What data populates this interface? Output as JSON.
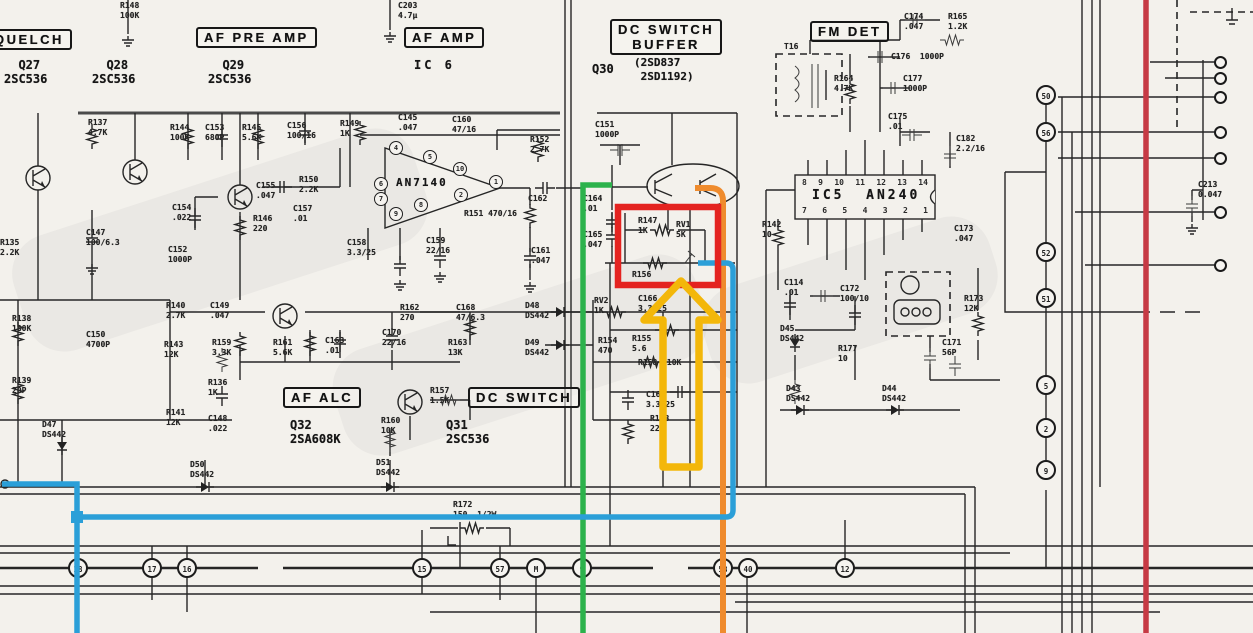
{
  "sections": {
    "squelch": "QUELCH",
    "af_pre_amp": "AF PRE AMP",
    "af_amp": "AF AMP",
    "dc_switch_buffer": "DC SWITCH\nBUFFER",
    "fm_det": "FM DET",
    "af_alc": "AF ALC",
    "dc_switch": "DC SWITCH"
  },
  "devices": {
    "q27": "  Q27\n2SC536",
    "q28": "  Q28\n2SC536",
    "q29": "  Q29\n2SC536",
    "ic6": "IC 6",
    "q30": "Q30",
    "q30_types": "(2SD837\n 2SD1192)",
    "an7140": "AN7140",
    "ic5": "IC5  AN240",
    "q32": "Q32\n2SA608K",
    "q31": "Q31\n2SC536"
  },
  "components": [
    {
      "x": 120,
      "y": 1,
      "t": "R148\n100K"
    },
    {
      "x": 398,
      "y": 1,
      "t": "C203\n4.7μ"
    },
    {
      "x": 88,
      "y": 118,
      "t": "R137\n4.7K"
    },
    {
      "x": 170,
      "y": 123,
      "t": "R144\n100K"
    },
    {
      "x": 205,
      "y": 123,
      "t": "C153\n680P"
    },
    {
      "x": 242,
      "y": 123,
      "t": "R145\n5.6K"
    },
    {
      "x": 287,
      "y": 121,
      "t": "C156\n100/16"
    },
    {
      "x": 340,
      "y": 119,
      "t": "R149\n1K"
    },
    {
      "x": 398,
      "y": 113,
      "t": "C145\n.047"
    },
    {
      "x": 452,
      "y": 115,
      "t": "C160\n47/16"
    },
    {
      "x": 530,
      "y": 135,
      "t": "R152\n2.7K"
    },
    {
      "x": 595,
      "y": 120,
      "t": "C151\n1000P"
    },
    {
      "x": 256,
      "y": 181,
      "t": "C155\n.047"
    },
    {
      "x": 299,
      "y": 175,
      "t": "R150\n2.2K"
    },
    {
      "x": 293,
      "y": 204,
      "t": "C157\n.01"
    },
    {
      "x": 253,
      "y": 214,
      "t": "R146\n220"
    },
    {
      "x": 172,
      "y": 203,
      "t": "C154\n.022"
    },
    {
      "x": 168,
      "y": 245,
      "t": "C152\n1000P"
    },
    {
      "x": 86,
      "y": 228,
      "t": "C147\n100/6.3"
    },
    {
      "x": 0,
      "y": 238,
      "t": "R135\n2.2K"
    },
    {
      "x": 12,
      "y": 314,
      "t": "R138\n180K"
    },
    {
      "x": 12,
      "y": 376,
      "t": "R139\n20P"
    },
    {
      "x": 86,
      "y": 330,
      "t": "C150\n4700P"
    },
    {
      "x": 166,
      "y": 301,
      "t": "R140\n2.7K"
    },
    {
      "x": 164,
      "y": 340,
      "t": "R143\n12K"
    },
    {
      "x": 166,
      "y": 408,
      "t": "R141\n12K"
    },
    {
      "x": 42,
      "y": 420,
      "t": "D47\nDS442"
    },
    {
      "x": 208,
      "y": 378,
      "t": "R136\n1K"
    },
    {
      "x": 208,
      "y": 414,
      "t": "C148\n.022"
    },
    {
      "x": 210,
      "y": 301,
      "t": "C149\n.047"
    },
    {
      "x": 212,
      "y": 338,
      "t": "R159\n3.3K"
    },
    {
      "x": 273,
      "y": 338,
      "t": "R161\n5.6K"
    },
    {
      "x": 325,
      "y": 336,
      "t": "C163\n.01"
    },
    {
      "x": 382,
      "y": 328,
      "t": "C170\n22/16"
    },
    {
      "x": 400,
      "y": 303,
      "t": "R162\n270"
    },
    {
      "x": 456,
      "y": 303,
      "t": "C168\n47/6.3"
    },
    {
      "x": 448,
      "y": 338,
      "t": "R163\n13K"
    },
    {
      "x": 525,
      "y": 301,
      "t": "D48\nDS442"
    },
    {
      "x": 525,
      "y": 338,
      "t": "D49\nDS442"
    },
    {
      "x": 381,
      "y": 416,
      "t": "R160\n10K"
    },
    {
      "x": 430,
      "y": 386,
      "t": "R157\n1.5K"
    },
    {
      "x": 190,
      "y": 460,
      "t": "D50\nDS442"
    },
    {
      "x": 376,
      "y": 458,
      "t": "D51\nDS442"
    },
    {
      "x": 347,
      "y": 238,
      "t": "C158\n3.3/25"
    },
    {
      "x": 426,
      "y": 236,
      "t": "C159\n22/16"
    },
    {
      "x": 464,
      "y": 209,
      "t": "R151 470/16"
    },
    {
      "x": 528,
      "y": 194,
      "t": "C162"
    },
    {
      "x": 531,
      "y": 246,
      "t": "C161\n.047"
    },
    {
      "x": 583,
      "y": 194,
      "t": "C164\n.01"
    },
    {
      "x": 583,
      "y": 230,
      "t": "C165\n.047"
    },
    {
      "x": 638,
      "y": 216,
      "t": "R147\n1K"
    },
    {
      "x": 676,
      "y": 220,
      "t": "RV1\n5K"
    },
    {
      "x": 632,
      "y": 270,
      "t": "R156"
    },
    {
      "x": 594,
      "y": 296,
      "t": "RV2\n1K"
    },
    {
      "x": 598,
      "y": 336,
      "t": "R154\n470"
    },
    {
      "x": 632,
      "y": 334,
      "t": "R155\n5.6"
    },
    {
      "x": 638,
      "y": 358,
      "t": "R158  10K"
    },
    {
      "x": 638,
      "y": 294,
      "t": "C166\n3.3/25"
    },
    {
      "x": 646,
      "y": 390,
      "t": "C167\n3.3/25"
    },
    {
      "x": 650,
      "y": 414,
      "t": "R153\n220"
    },
    {
      "x": 762,
      "y": 220,
      "t": "R142\n10"
    },
    {
      "x": 784,
      "y": 42,
      "t": "T16"
    },
    {
      "x": 834,
      "y": 74,
      "t": "R164\n4.7K"
    },
    {
      "x": 904,
      "y": 12,
      "t": "C174\n.047"
    },
    {
      "x": 948,
      "y": 12,
      "t": "R165\n1.2K"
    },
    {
      "x": 891,
      "y": 52,
      "t": "C176  1000P"
    },
    {
      "x": 903,
      "y": 74,
      "t": "C177\n1000P"
    },
    {
      "x": 888,
      "y": 112,
      "t": "C175\n.01"
    },
    {
      "x": 956,
      "y": 134,
      "t": "C182\n2.2/16"
    },
    {
      "x": 954,
      "y": 224,
      "t": "C173\n.047"
    },
    {
      "x": 784,
      "y": 278,
      "t": "C114\n.01"
    },
    {
      "x": 840,
      "y": 284,
      "t": "C172\n100/10"
    },
    {
      "x": 780,
      "y": 324,
      "t": "D45\nDS442"
    },
    {
      "x": 838,
      "y": 344,
      "t": "R177\n10"
    },
    {
      "x": 964,
      "y": 294,
      "t": "R173\n12K"
    },
    {
      "x": 942,
      "y": 338,
      "t": "C171\n56P"
    },
    {
      "x": 786,
      "y": 384,
      "t": "D43\nDS442"
    },
    {
      "x": 882,
      "y": 384,
      "t": "D44\nDS442"
    },
    {
      "x": 453,
      "y": 500,
      "t": "R172\n150  1/2W"
    },
    {
      "x": 1198,
      "y": 180,
      "t": "C213\n0.047"
    }
  ],
  "an7140_pins": [
    {
      "n": "4",
      "x": 396,
      "y": 148
    },
    {
      "n": "5",
      "x": 430,
      "y": 157
    },
    {
      "n": "10",
      "x": 460,
      "y": 169
    },
    {
      "n": "1",
      "x": 496,
      "y": 182
    },
    {
      "n": "2",
      "x": 461,
      "y": 195
    },
    {
      "n": "8",
      "x": 421,
      "y": 205
    },
    {
      "n": "7",
      "x": 381,
      "y": 199
    },
    {
      "n": "9",
      "x": 396,
      "y": 214
    },
    {
      "n": "6",
      "x": 381,
      "y": 184
    }
  ],
  "ic5_pins_top": [
    "8",
    "9",
    "10",
    "11",
    "12",
    "13",
    "14"
  ],
  "ic5_pins_bottom": [
    "7",
    "6",
    "5",
    "4",
    "3",
    "2",
    "1"
  ],
  "terminals_bottom": [
    {
      "n": "18",
      "x": 78
    },
    {
      "n": "17",
      "x": 152
    },
    {
      "n": "16",
      "x": 187
    },
    {
      "n": "15",
      "x": 422
    },
    {
      "n": "57",
      "x": 500
    },
    {
      "n": "M",
      "x": 536
    },
    {
      "n": "9",
      "x": 582
    },
    {
      "n": "58",
      "x": 723
    },
    {
      "n": "40",
      "x": 748
    },
    {
      "n": "12",
      "x": 845
    }
  ],
  "terminals_right_col": [
    {
      "n": "50",
      "y": 95
    },
    {
      "n": "56",
      "y": 132
    },
    {
      "n": "52",
      "y": 252
    },
    {
      "n": "51",
      "y": 298
    },
    {
      "n": "5",
      "y": 385
    },
    {
      "n": "2",
      "y": 428
    },
    {
      "n": "9",
      "y": 470
    }
  ],
  "edge_pins": [
    {
      "y": 62
    },
    {
      "y": 78
    },
    {
      "y": 97
    },
    {
      "y": 132
    },
    {
      "y": 158
    },
    {
      "y": 212
    },
    {
      "y": 265
    }
  ],
  "annotations": {
    "highlight_box_color": "#e42320",
    "arrow_color": "#f3b70a",
    "trace_green": "#2cb24c",
    "trace_orange": "#ef8b2d",
    "trace_blue": "#2b9fd8",
    "vertical_line_red": "#c63a44"
  }
}
